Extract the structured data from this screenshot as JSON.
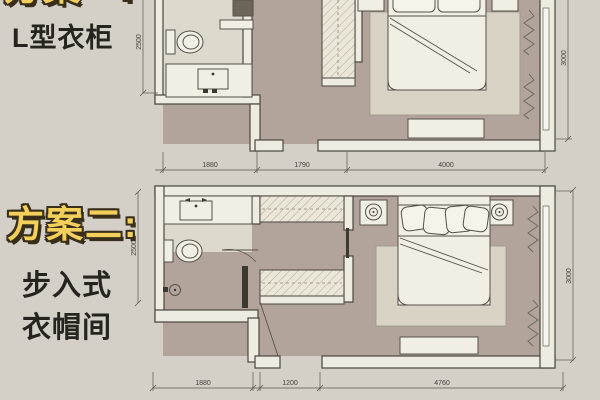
{
  "colors": {
    "background": "#d4d0c8",
    "floor": "#b2a49a",
    "bathroom_floor": "#ddd9cc",
    "wall_fill": "#eeebe0",
    "wall_stroke": "#4a473f",
    "furniture_fill": "#f1eee3",
    "rug_fill": "#d8d3c5",
    "accent_yellow": "#f3d05b",
    "title_outline": "#382e1a",
    "text_dark": "#27241f"
  },
  "sidebar": {
    "scheme1_title": "方案一:",
    "scheme1_sub": "L型衣柜",
    "scheme2_title": "方案二:",
    "scheme2_sub1": "步入式",
    "scheme2_sub2": "衣帽间"
  },
  "plan_top": {
    "dims": [
      "1880",
      "1790",
      "4000"
    ],
    "dim_left": "2500",
    "dim_right": "3000"
  },
  "plan_bottom": {
    "dims": [
      "1880",
      "1200",
      "4760"
    ],
    "dim_left": "2500",
    "dim_right": "3000"
  }
}
